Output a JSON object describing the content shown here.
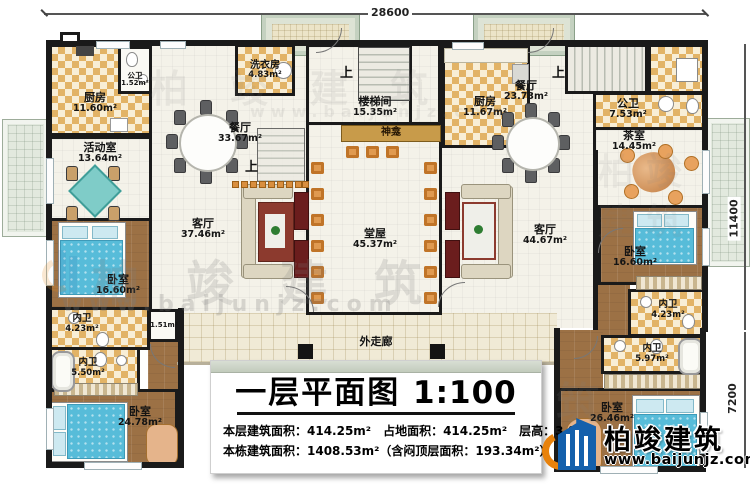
{
  "dimensions": {
    "top": "28600",
    "right_upper": "11400",
    "right_lower": "7200"
  },
  "rooms": {
    "kitchen_left": {
      "name": "厨房",
      "area": "11.60m²"
    },
    "pubbath_small": {
      "name": "公卫",
      "area": "1.52m²"
    },
    "laundry": {
      "name": "洗衣房",
      "area": "4.83m²"
    },
    "dining_left": {
      "name": "餐厅",
      "area": "33.67m²"
    },
    "activity": {
      "name": "活动室",
      "area": "13.64m²"
    },
    "stairwell": {
      "name": "楼梯间",
      "area": "15.35m²"
    },
    "shrine": {
      "name": "神龛"
    },
    "hall": {
      "name": "堂屋",
      "area": "45.37m²"
    },
    "kitchen_right": {
      "name": "厨房",
      "area": "11.67m²"
    },
    "dining_right": {
      "name": "餐厅",
      "area": "23.73m²"
    },
    "pubbath_right": {
      "name": "公卫",
      "area": "7.53m²"
    },
    "tea_room": {
      "name": "茶室",
      "area": "14.45m²"
    },
    "living_left": {
      "name": "客厅",
      "area": "37.46m²"
    },
    "living_right": {
      "name": "客厅",
      "area": "44.67m²"
    },
    "bedroom_left1": {
      "name": "卧室",
      "area": "16.60m²"
    },
    "bath_left1": {
      "name": "内卫",
      "area": "4.23m²"
    },
    "closet": {
      "area": "1.51m²"
    },
    "bath_left2": {
      "name": "内卫",
      "area": "5.50m²"
    },
    "bedroom_left2": {
      "name": "卧室",
      "area": "24.78m²"
    },
    "bedroom_right1": {
      "name": "卧室",
      "area": "16.60m²"
    },
    "bath_right1": {
      "name": "内卫",
      "area": "4.23m²"
    },
    "bath_right2": {
      "name": "内卫",
      "area": "5.97m²"
    },
    "bedroom_right2": {
      "name": "卧室",
      "area": "26.46m²"
    },
    "corridor": {
      "name": "外走廊"
    }
  },
  "annotations": {
    "up": "上"
  },
  "title_block": {
    "title": "一层平面图",
    "scale": "1:100",
    "line1": "本层建筑面积：414.25m²　占地面积：414.25m²　层高：3.8m",
    "line2": "本栋建筑面积：1408.53m²（含闷顶层面积：193.34m²）"
  },
  "brand": {
    "name": "柏竣建筑",
    "url": "www.baijunjz.com"
  },
  "watermark": {
    "name": "柏竣建筑",
    "url": "www.baijunjz.com"
  },
  "colors": {
    "wall": "#1a1a1a",
    "checker_tile": "#e2b366",
    "wood": "#9c7145",
    "bed_blue": "#57bcd9",
    "brand_blue": "#1460ac",
    "brand_orange": "#e8820c"
  }
}
